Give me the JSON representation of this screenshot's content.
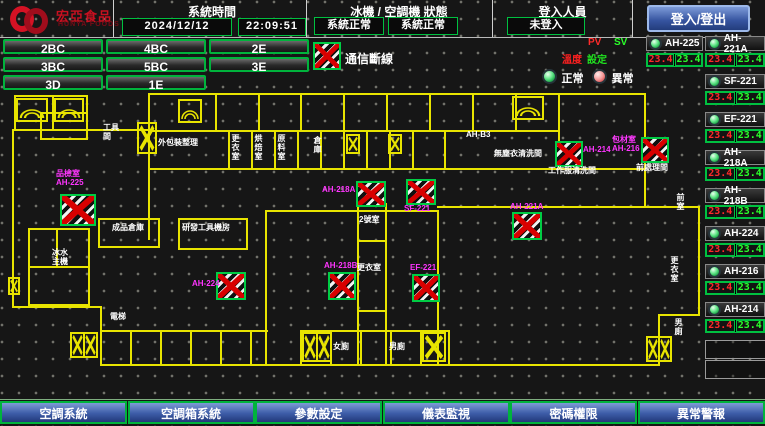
{
  "header": {
    "brand": "宏亞食品",
    "brand_en": "HUNYA FOODS",
    "time_section": {
      "title": "系統時間",
      "date": "2024/12/12",
      "time": "22:09:51"
    },
    "status_section": {
      "title": "冰機 / 空調機 狀態",
      "chiller_status": "系統正常",
      "ahu_status": "系統正常"
    },
    "login_section": {
      "title": "登入人員",
      "user": "未登入"
    },
    "login_button": "登入/登出"
  },
  "floor_buttons": [
    "2BC",
    "4BC",
    "2E",
    "3BC",
    "5BC",
    "3E",
    "3D",
    "1E"
  ],
  "legend": {
    "comm_loss": "通信斷線",
    "pv": "PV",
    "sv": "SV",
    "temp": "溫度",
    "setpoint": "設定",
    "normal": "正常",
    "abnormal": "異常"
  },
  "equipment_panel": {
    "entries": [
      {
        "name": "AH-225",
        "pv": "23.4",
        "sv": "23.4",
        "x": 646,
        "y": 36,
        "w": 57
      },
      {
        "name": "AH-221A",
        "pv": "23.4",
        "sv": "23.4",
        "x": 705,
        "y": 36,
        "w": 60
      },
      {
        "name": "SF-221",
        "pv": "23.4",
        "sv": "23.4",
        "x": 705,
        "y": 74,
        "w": 60
      },
      {
        "name": "EF-221",
        "pv": "23.4",
        "sv": "23.4",
        "x": 705,
        "y": 112,
        "w": 60
      },
      {
        "name": "AH-218A",
        "pv": "23.4",
        "sv": "23.4",
        "x": 705,
        "y": 150,
        "w": 60
      },
      {
        "name": "AH-218B",
        "pv": "23.4",
        "sv": "23.4",
        "x": 705,
        "y": 188,
        "w": 60
      },
      {
        "name": "AH-224",
        "pv": "23.4",
        "sv": "23.4",
        "x": 705,
        "y": 226,
        "w": 60
      },
      {
        "name": "AH-216",
        "pv": "23.4",
        "sv": "23.4",
        "x": 705,
        "y": 264,
        "w": 60
      },
      {
        "name": "AH-214",
        "pv": "23.4",
        "sv": "23.4",
        "x": 705,
        "y": 302,
        "w": 60
      }
    ],
    "empty_slots": [
      [
        705,
        340,
        60,
        17
      ],
      [
        705,
        360,
        60,
        17
      ]
    ]
  },
  "bottom_nav": [
    "空調系統",
    "空調箱系統",
    "參數設定",
    "儀表監視",
    "密碼權限",
    "異常警報"
  ],
  "colors": {
    "wall_yellow": "#e8e400",
    "ok_green": "#00c040",
    "alarm_red": "#ff2a2a",
    "tag_magenta": "#ff35ff",
    "button_blue": "#3d5ca8",
    "brand_red": "#d41224"
  },
  "plan": {
    "walls": [
      [
        14,
        95,
        74,
        2
      ],
      [
        14,
        95,
        2,
        36
      ],
      [
        86,
        95,
        2,
        36
      ],
      [
        14,
        129,
        74,
        2
      ],
      [
        52,
        95,
        2,
        36
      ],
      [
        12,
        129,
        2,
        178
      ],
      [
        40,
        112,
        48,
        2
      ],
      [
        40,
        138,
        48,
        2
      ],
      [
        40,
        112,
        2,
        26
      ],
      [
        86,
        112,
        2,
        26
      ],
      [
        88,
        129,
        62,
        2
      ],
      [
        148,
        93,
        2,
        77
      ],
      [
        150,
        93,
        496,
        2
      ],
      [
        644,
        93,
        2,
        77
      ],
      [
        150,
        130,
        408,
        2
      ],
      [
        148,
        168,
        498,
        2
      ],
      [
        215,
        93,
        2,
        37
      ],
      [
        258,
        93,
        2,
        37
      ],
      [
        300,
        93,
        2,
        37
      ],
      [
        343,
        93,
        2,
        37
      ],
      [
        386,
        93,
        2,
        37
      ],
      [
        429,
        93,
        2,
        37
      ],
      [
        472,
        93,
        2,
        37
      ],
      [
        515,
        93,
        2,
        37
      ],
      [
        558,
        93,
        2,
        77
      ],
      [
        228,
        130,
        2,
        38
      ],
      [
        251,
        130,
        2,
        38
      ],
      [
        274,
        130,
        2,
        38
      ],
      [
        297,
        130,
        2,
        38
      ],
      [
        320,
        130,
        2,
        38
      ],
      [
        343,
        130,
        2,
        38
      ],
      [
        366,
        130,
        2,
        38
      ],
      [
        389,
        130,
        2,
        38
      ],
      [
        412,
        130,
        2,
        38
      ],
      [
        444,
        130,
        2,
        38
      ],
      [
        12,
        306,
        90,
        2
      ],
      [
        100,
        306,
        2,
        60
      ],
      [
        100,
        364,
        560,
        2
      ],
      [
        644,
        168,
        2,
        40
      ],
      [
        644,
        206,
        56,
        2
      ],
      [
        698,
        206,
        2,
        110
      ],
      [
        658,
        314,
        42,
        2
      ],
      [
        658,
        314,
        2,
        52
      ],
      [
        28,
        228,
        62,
        2
      ],
      [
        28,
        228,
        2,
        78
      ],
      [
        88,
        228,
        2,
        78
      ],
      [
        28,
        304,
        62,
        2
      ],
      [
        28,
        266,
        62,
        2
      ],
      [
        56,
        228,
        2,
        40
      ],
      [
        265,
        210,
        2,
        155
      ],
      [
        265,
        210,
        174,
        2
      ],
      [
        437,
        210,
        2,
        155
      ],
      [
        357,
        203,
        2,
        162
      ],
      [
        385,
        203,
        2,
        162
      ],
      [
        357,
        240,
        30,
        2
      ],
      [
        357,
        310,
        30,
        2
      ],
      [
        437,
        206,
        263,
        2
      ],
      [
        98,
        218,
        62,
        2
      ],
      [
        98,
        218,
        2,
        28
      ],
      [
        158,
        218,
        2,
        28
      ],
      [
        98,
        246,
        62,
        2
      ],
      [
        178,
        218,
        70,
        2
      ],
      [
        178,
        218,
        2,
        30
      ],
      [
        246,
        218,
        2,
        30
      ],
      [
        178,
        248,
        70,
        2
      ],
      [
        148,
        168,
        2,
        72
      ],
      [
        100,
        330,
        168,
        2
      ],
      [
        130,
        330,
        2,
        34
      ],
      [
        160,
        330,
        2,
        34
      ],
      [
        190,
        330,
        2,
        34
      ],
      [
        220,
        330,
        2,
        34
      ],
      [
        250,
        330,
        2,
        34
      ],
      [
        300,
        330,
        150,
        2
      ],
      [
        300,
        330,
        2,
        34
      ],
      [
        330,
        330,
        2,
        34
      ],
      [
        360,
        330,
        2,
        34
      ],
      [
        390,
        330,
        2,
        34
      ],
      [
        420,
        330,
        2,
        34
      ],
      [
        448,
        330,
        2,
        34
      ]
    ],
    "markers": [
      [
        60,
        194,
        36,
        32
      ],
      [
        216,
        272,
        30,
        28
      ],
      [
        356,
        181,
        30,
        26
      ],
      [
        406,
        179,
        30,
        26
      ],
      [
        328,
        272,
        28,
        28
      ],
      [
        412,
        274,
        28,
        28
      ],
      [
        512,
        212,
        30,
        28
      ],
      [
        555,
        141,
        28,
        26
      ],
      [
        641,
        137,
        28,
        26
      ]
    ],
    "xboxes": [
      [
        137,
        122,
        20,
        32,
        1
      ],
      [
        346,
        134,
        14,
        20,
        1
      ],
      [
        388,
        134,
        14,
        20,
        1
      ],
      [
        8,
        277,
        12,
        18,
        1
      ],
      [
        70,
        332,
        28,
        26,
        2
      ],
      [
        302,
        332,
        30,
        30,
        2
      ],
      [
        422,
        332,
        24,
        30,
        1
      ],
      [
        646,
        336,
        26,
        26,
        2
      ]
    ],
    "arcs": [
      [
        16,
        98,
        32,
        24
      ],
      [
        54,
        98,
        30,
        24
      ],
      [
        178,
        99,
        24,
        24
      ],
      [
        512,
        96,
        32,
        24
      ]
    ],
    "labels": [
      {
        "t": "工具\n間",
        "x": 103,
        "y": 123,
        "c": "w"
      },
      {
        "t": "外包裝整理",
        "x": 158,
        "y": 138,
        "c": "w"
      },
      {
        "t": "更衣室",
        "x": 231,
        "y": 134,
        "c": "w",
        "v": 1
      },
      {
        "t": "烘焙室",
        "x": 254,
        "y": 134,
        "c": "w",
        "v": 1
      },
      {
        "t": "原料室",
        "x": 277,
        "y": 134,
        "c": "w",
        "v": 1
      },
      {
        "t": "倉庫",
        "x": 313,
        "y": 136,
        "c": "w",
        "v": 1
      },
      {
        "t": "AH-B3",
        "x": 466,
        "y": 130,
        "c": "w"
      },
      {
        "t": "無塵衣清洗間",
        "x": 494,
        "y": 149,
        "c": "w"
      },
      {
        "t": "工作服清洗間",
        "x": 548,
        "y": 166,
        "c": "w"
      },
      {
        "t": "前處理間",
        "x": 636,
        "y": 163,
        "c": "w"
      },
      {
        "t": "成品倉庫",
        "x": 112,
        "y": 223,
        "c": "w"
      },
      {
        "t": "研發工具機房",
        "x": 182,
        "y": 223,
        "c": "w"
      },
      {
        "t": "2號室",
        "x": 359,
        "y": 215,
        "c": "w"
      },
      {
        "t": "更衣室",
        "x": 357,
        "y": 263,
        "c": "w"
      },
      {
        "t": "冰水\n主機",
        "x": 52,
        "y": 248,
        "c": "w"
      },
      {
        "t": "電梯",
        "x": 110,
        "y": 312,
        "c": "w"
      },
      {
        "t": "女廁",
        "x": 333,
        "y": 342,
        "c": "w"
      },
      {
        "t": "男廁",
        "x": 389,
        "y": 342,
        "c": "w"
      },
      {
        "t": "前室",
        "x": 676,
        "y": 193,
        "c": "w",
        "v": 1
      },
      {
        "t": "更衣室",
        "x": 670,
        "y": 256,
        "c": "w",
        "v": 1
      },
      {
        "t": "男廁",
        "x": 674,
        "y": 318,
        "c": "w",
        "v": 1
      },
      {
        "t": "品檢室\nAH-225",
        "x": 56,
        "y": 169,
        "c": "m"
      },
      {
        "t": "AH-224",
        "x": 192,
        "y": 279,
        "c": "m"
      },
      {
        "t": "AH-218A",
        "x": 322,
        "y": 185,
        "c": "m"
      },
      {
        "t": "SF-221",
        "x": 404,
        "y": 204,
        "c": "m"
      },
      {
        "t": "AH-218B",
        "x": 324,
        "y": 261,
        "c": "m"
      },
      {
        "t": "EF-221",
        "x": 410,
        "y": 263,
        "c": "m"
      },
      {
        "t": "AH-221A",
        "x": 510,
        "y": 202,
        "c": "m"
      },
      {
        "t": "AH-214",
        "x": 583,
        "y": 145,
        "c": "m"
      },
      {
        "t": "包材室\nAH-216",
        "x": 612,
        "y": 135,
        "c": "m"
      }
    ]
  }
}
